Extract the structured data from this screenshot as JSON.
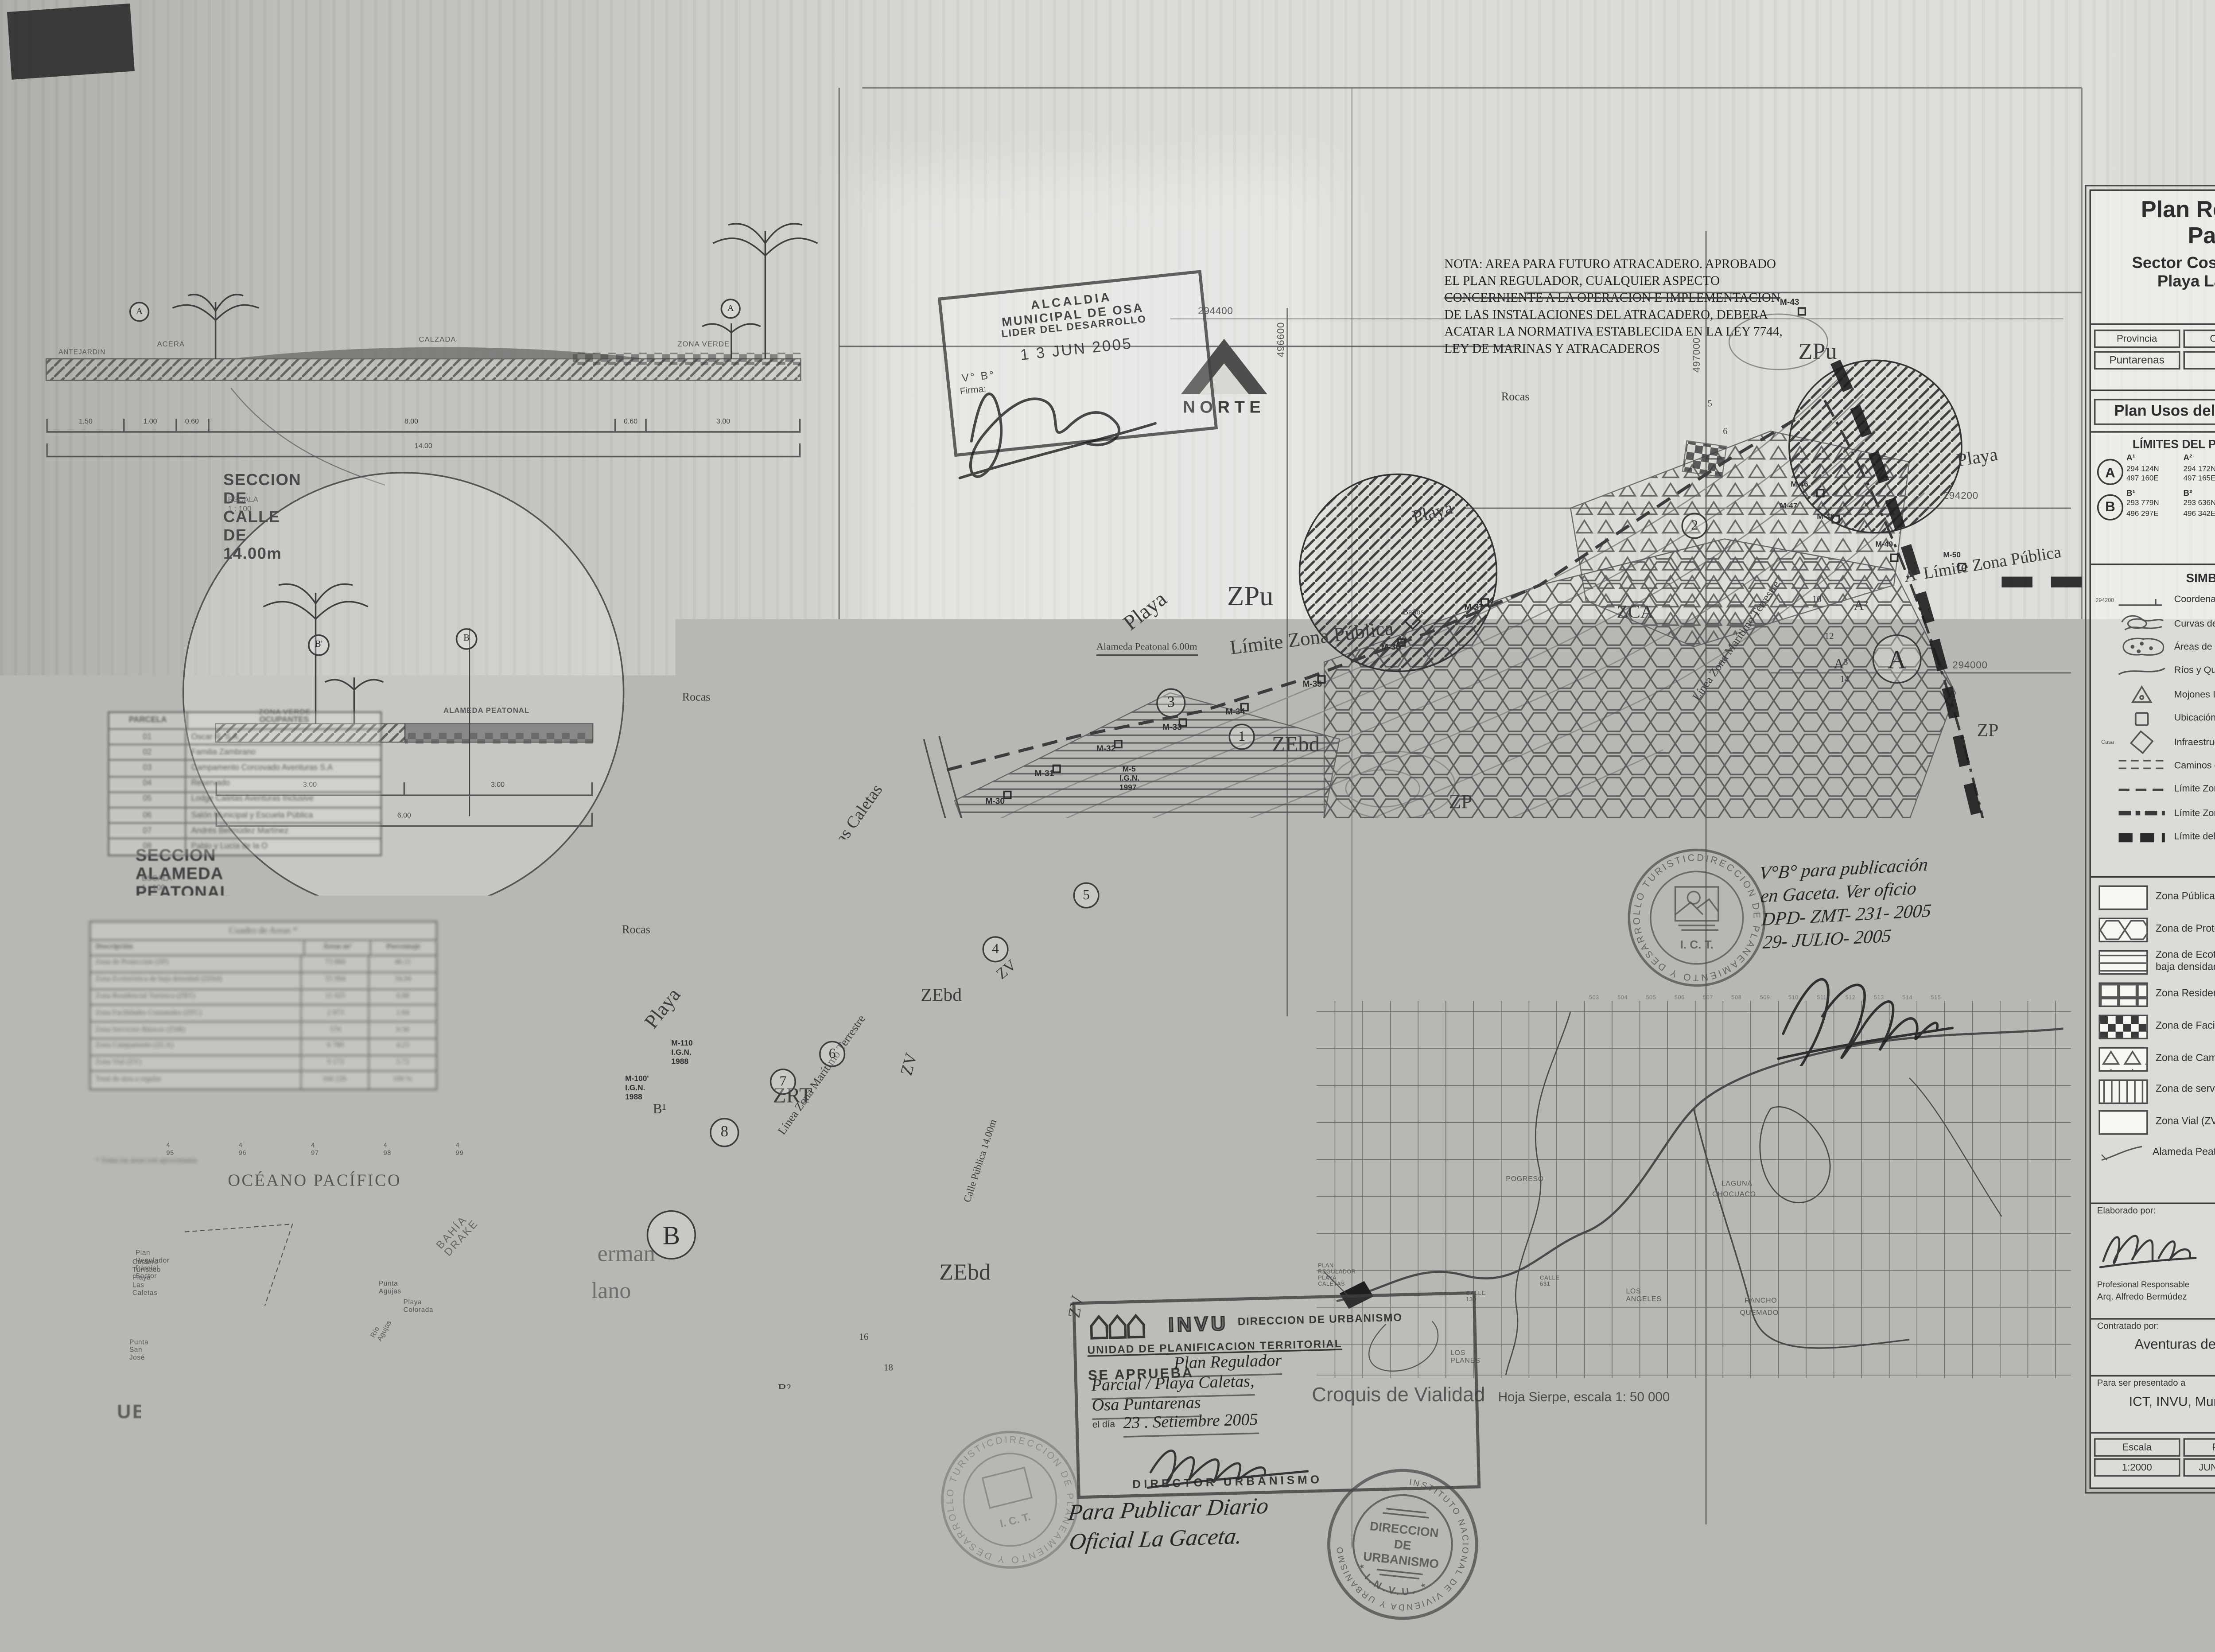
{
  "title_block": {
    "title1": "Plan Regulador",
    "title2": "Parcial",
    "subtitle1": "Sector Costero Turístico",
    "subtitle2": "Playa Las Caletas",
    "admin_headers": [
      "Provincia",
      "Cantón",
      "Distrito"
    ],
    "admin_values": [
      "Puntarenas",
      "Osa",
      "Sierpe"
    ],
    "plan_title": "Plan Usos del Suelo y Vialidad",
    "limits": {
      "heading": "LÍMITES DEL PLAN REGULADOR",
      "a_label": "A",
      "b_label": "B",
      "a_points": [
        {
          "p": "A¹",
          "n": "294 124N",
          "e": "497 160E"
        },
        {
          "p": "A²",
          "n": "294 172N",
          "e": "497 165E"
        },
        {
          "p": "A³",
          "n": "294 119N",
          "e": "497 152E"
        },
        {
          "p": "A⁴",
          "n": "294 019N",
          "e": "497 189E"
        }
      ],
      "b_points": [
        {
          "p": "B¹",
          "n": "293 779N",
          "e": "496 297E"
        },
        {
          "p": "B²",
          "n": "293 636N",
          "e": "496 342E"
        }
      ]
    },
    "simbologia_heading": "SIMBOLOGÍA",
    "simbologia": [
      {
        "icon": "#sym-lambert",
        "note": "294200",
        "label": "Coordenadas Lambert"
      },
      {
        "icon": "#sym-contour",
        "note": "",
        "label": "Curvas de NiveL @ 2.00m"
      },
      {
        "icon": "#sym-marsh",
        "note": "",
        "label": "Áreas de encharcamiento"
      },
      {
        "icon": "#sym-river",
        "note": "",
        "label": "Ríos y Quebradas"
      },
      {
        "icon": "#sym-mojon",
        "note": "",
        "label": "Mojones I.G.N."
      },
      {
        "icon": "#sym-mojonhip",
        "note": "",
        "label": "Ubicación hipotética de mojones"
      },
      {
        "icon": "#sym-infra",
        "note": "Casa",
        "label": "Infraestructura existente"
      },
      {
        "icon": "#sym-camino",
        "note": "",
        "label": "Caminos existentes"
      },
      {
        "icon": "#sym-lzp",
        "note": "",
        "label": "Límite Zona Pública"
      },
      {
        "icon": "#sym-lzmt",
        "note": "",
        "label": "Límite Zona Marítimo Terrestre"
      },
      {
        "icon": "#sym-lpr",
        "note": "",
        "label": "Límite del Plan Regulador"
      }
    ],
    "zones": [
      {
        "fill": "url(#pat-plain)",
        "label": "Zona Pública (ZPu)",
        "label2": ""
      },
      {
        "fill": "url(#pat-hex)",
        "label": "Zona de Protección (ZP)",
        "label2": ""
      },
      {
        "fill": "url(#pat-hlines)",
        "label": "Zona de Ecoturistica de",
        "label2": "baja densidad (ZEbd)"
      },
      {
        "fill": "url(#pat-grid)",
        "label": "Zona Residencial Turística (ZRT)",
        "label2": ""
      },
      {
        "fill": "url(#pat-checker)",
        "label": "Zona de Facilidades Comunales (ZFC)",
        "label2": ""
      },
      {
        "fill": "url(#pat-tri)",
        "label": "Zona de Campamento (ZCA)",
        "label2": ""
      },
      {
        "fill": "url(#pat-vlines)",
        "label": "Zona de servicios básicos (ZSB)",
        "label2": ""
      },
      {
        "fill": "url(#pat-plain)",
        "label": "Zona Vial  (ZV)",
        "label2": ""
      }
    ],
    "alameda_label": "Alameda Peatonal",
    "elaborado_label": "Elaborado por:",
    "profesional_role": "Profesional Responsable",
    "profesional_name": "Arq. Alfredo Bermúdez",
    "deppat": "DEPPAT",
    "reg": "N° de Reg A-4043",
    "contratado_label": "Contratado por:",
    "contratado_value": "Aventuras de Corcovado S.A.",
    "presentado_label": "Para ser presentado a",
    "presentado_value": "ICT, INVU, Municipalidad de Osa",
    "footer_headers": [
      "Escala",
      "Fecha",
      "Lamina"
    ],
    "footer_values": [
      "1:2000",
      "JUNIO 2005",
      "19"
    ]
  },
  "nota_lines": [
    "NOTA: AREA PARA FUTURO ATRACADERO. APROBADO",
    "EL PLAN REGULADOR, CUALQUIER ASPECTO",
    "CONCERNIENTE A LA OPERACION E IMPLEMENTACION",
    "DE LAS INSTALACIONES DEL ATRACADERO, DEBERA",
    "ACATAR LA NORMATIVA ESTABLECIDA EN LA LEY 7744,",
    "LEY DE MARINAS Y ATRACADEROS"
  ],
  "norte": "NORTE",
  "street_section": {
    "title": "SECCION DE CALLE DE 14.00m",
    "scale": "ESCALA  1 : 100",
    "labels": [
      "ANTEJARDIN",
      "ACERA",
      "CALZADA",
      "ZONA VERDE"
    ],
    "marker": "A",
    "dims": [
      "1.50",
      "1.00",
      "0.60",
      "8.00",
      "0.60",
      "3.00"
    ],
    "total": "14.00"
  },
  "alameda_section": {
    "title": "SECCION ALAMEDA PEATONAL DE 6.00m",
    "scale": "ESCALA  1 : 100",
    "label_left": "ZONA VERDE",
    "label_right": "ALAMEDA PEATONAL",
    "marker_left": "B'",
    "marker_right": "B",
    "dims": [
      "3.00",
      "3.00"
    ],
    "total": "6.00"
  },
  "parcelas": {
    "headers": [
      "PARCELA",
      "OCUPANTES"
    ],
    "rows": [
      [
        "01",
        "Oscar R. S.A."
      ],
      [
        "02",
        "Familia Zambrano"
      ],
      [
        "03",
        "Campamento Corcovado Aventuras S.A"
      ],
      [
        "04",
        "Reservado"
      ],
      [
        "05",
        "Lodge Caletas Aventuras Inclusive"
      ],
      [
        "06",
        "Salón Municipal y Escuela Pública"
      ],
      [
        "07",
        "Andrés Bermúdez Martínez"
      ],
      [
        "08",
        "Pablo y Lucía de la O"
      ]
    ]
  },
  "areas": {
    "title": "Cuadro de Areas *",
    "headers": [
      "Descripción",
      "Áreas m²",
      "Porcentaje"
    ],
    "rows": [
      [
        "Zona de Protección (ZP)",
        "73 860",
        "46.11"
      ],
      [
        "Zona Ecoturística de baja densidad (ZEbd)",
        "55 994",
        "34.94"
      ],
      [
        "Zona Residencial Turística (ZRT)",
        "11 025",
        "6.88"
      ],
      [
        "Zona Facilidades Comunales (ZFC)",
        "2 973",
        "1.84"
      ],
      [
        "Zona Servicios Básicos (ZSB)",
        "570",
        "0.36"
      ],
      [
        "Zona Campamento (ZCA)",
        "6 780",
        "4.23"
      ],
      [
        "Zona Vial (ZV)",
        "9 173",
        "5.72"
      ]
    ],
    "total_row": [
      "Total de área a regular",
      "160 226",
      "100 %"
    ],
    "footnote": "*   Todas las áreas son aproximadas"
  },
  "ubicacion": {
    "ocean": "OCÉANO PACÍFICO",
    "ticks": [
      "4 95",
      "4 96",
      "4 97",
      "4 98",
      "4 99"
    ],
    "labels": [
      {
        "text": "Plan Regulador Parcial Sector",
        "style": "left:88px;top:811px;font-size:4.4px;"
      },
      {
        "text": "Costero Turístico Playa Las Caletas",
        "style": "left:86px;top:817px;font-size:4.4px;"
      },
      {
        "text": "BAHÍA DRAKE",
        "style": "left:283px;top:795px;font-size:7px;transform:rotate(-48deg);letter-spacing:1px;color:#666;"
      },
      {
        "text": "Punta Agujas",
        "style": "left:246px;top:831px;font-size:4.4px;"
      },
      {
        "text": "Playa Colorada",
        "style": "left:262px;top:843px;font-size:4.4px;"
      },
      {
        "text": "Punta San José",
        "style": "left:84px;top:869px;font-size:4.4px;"
      },
      {
        "text": "Río Agujas",
        "style": "left:240px;top:858px;font-size:4.4px;transform:rotate(-62deg);"
      }
    ],
    "caption": "UBICACIÓN GEOGRÁFICA",
    "caption2": "Hoja Topográfica Sierpe. Escala 1:50000 I.G.N."
  },
  "croquis": {
    "title": "Croquis de Vialidad",
    "subtitle": "Hoja Sierpe, escala 1: 50 000",
    "cols": [
      "503",
      "504",
      "505",
      "506",
      "507",
      "508",
      "509",
      "510",
      "511",
      "512",
      "513",
      "514",
      "515"
    ],
    "labels": [
      {
        "text": "POGRESO",
        "style": "left:978px;top:763px;"
      },
      {
        "text": "LAGUNA",
        "style": "left:1118px;top:766px;"
      },
      {
        "text": "CHOCUACO",
        "style": "left:1112px;top:773px;"
      },
      {
        "text": "LOS ANGELES",
        "style": "left:1056px;top:836px;"
      },
      {
        "text": "CALLE 631",
        "style": "left:1000px;top:828px;font-size:3.8px;"
      },
      {
        "text": "CALLE 130",
        "style": "left:952px;top:838px;font-size:3.8px;"
      },
      {
        "text": "LOS PLANES",
        "style": "left:942px;top:876px;"
      },
      {
        "text": "RANCHO",
        "style": "left:1133px;top:842px;"
      },
      {
        "text": "QUEMADO",
        "style": "left:1130px;top:850px;"
      },
      {
        "text": "PLAN REGULADOR PLAYA CALETAS",
        "style": "left:856px;top:820px;font-size:3.6px;"
      }
    ]
  },
  "stamps": {
    "alcaldia": {
      "l1": "ALCALDIA",
      "l2": "MUNICIPAL DE OSA",
      "l3": "LIDER DEL DESARROLLO",
      "date": "1 3  JUN 2005",
      "vb": "V° B°",
      "firma": "Firma:"
    },
    "ict": {
      "ring": "DIRECCION DE PLANEAMIENTO Y DESARROLLO TURISTICO *",
      "center": "I. C. T."
    },
    "invu_box": {
      "brand": "INVU",
      "t1": "DIRECCION DE URBANISMO",
      "t2": "UNIDAD DE PLANIFICACION TERRITORIAL",
      "t3": "SE APRUEBA",
      "hand1": "Plan Regulador",
      "hand2": "Parcial / Playa Caletas,",
      "hand3": "Osa  Puntarenas",
      "dia": "el día",
      "hand4": "23 .   Setiembre 2005",
      "sig_role": "DIRECTOR URBANISMO"
    },
    "invu_round": {
      "ring": "INSTITUTO NACIONAL DE VIVIENDA Y URBANISMO",
      "star": "* I.N.V.U. *",
      "c1": "DIRECCION",
      "c2": "DE",
      "c3": "URBANISMO"
    }
  },
  "handwriting": {
    "vobo": [
      "V°B° para publicación",
      "en Gaceta. Ver oficio",
      "DPD- ZMT- 231- 2005",
      "29- JULIO- 2005"
    ],
    "gaceta": [
      "Para Publicar Diario",
      "Oficial La Gaceta."
    ]
  },
  "map": {
    "coords": [
      {
        "text": "294400",
        "style": "left:778px;top:200px;font-size:6.5px;"
      },
      {
        "text": "496600",
        "style": "left:830px;top:232px;font-size:6.5px;transform:rotate(-90deg);"
      },
      {
        "text": "497000",
        "style": "left:1100px;top:242px;font-size:6.5px;transform:rotate(-90deg);"
      },
      {
        "text": "294200",
        "style": "left:1262px;top:320px;font-size:6.5px;"
      },
      {
        "text": "294000",
        "style": "left:1268px;top:430px;font-size:6.5px;"
      }
    ],
    "labels": [
      {
        "text": "ZPu",
        "style": "left:797px;top:378px;font-size:18px;"
      },
      {
        "text": "ZPu",
        "style": "left:1168px;top:222px;font-size:15px;"
      },
      {
        "text": "ZPu",
        "style": "left:570px;top:588px;font-size:14px;"
      },
      {
        "text": "ZP",
        "style": "left:941px;top:514px;font-size:13px;"
      },
      {
        "text": "ZP",
        "style": "left:1284px;top:468px;font-size:12px;"
      },
      {
        "text": "ZEbd",
        "style": "left:826px;top:478px;font-size:14px;"
      },
      {
        "text": "ZEbd",
        "style": "left:698px;top:543px;font-size:12px;"
      },
      {
        "text": "ZEbd",
        "style": "left:598px;top:640px;font-size:12px;"
      },
      {
        "text": "ZEbd",
        "style": "left:610px;top:820px;font-size:15px;"
      },
      {
        "text": "ZCA",
        "style": "left:1050px;top:391px;font-size:12px;"
      },
      {
        "text": "ZRT",
        "style": "left:502px;top:706px;font-size:14px;"
      },
      {
        "text": "ZV",
        "style": "left:584px;top:697px;font-size:11px;transform:rotate(-75deg);"
      },
      {
        "text": "ZV",
        "style": "left:646px;top:631px;font-size:10px;transform:rotate(-40deg);"
      },
      {
        "text": "ZV",
        "style": "left:693px;top:855px;font-size:11px;transform:rotate(-80deg);"
      },
      {
        "text": "Calle Pública 14.00m",
        "style": "left:626px;top:780px;font-size:6.5px;transform:rotate(-72deg);"
      },
      {
        "text": "Límite Zona Pública",
        "style": "left:798px;top:414px;font-size:13px;transform:rotate(-7deg);"
      },
      {
        "text": "A' Límite Zona Pública",
        "style": "left:1236px;top:370px;font-size:11px;transform:rotate(-9deg);"
      },
      {
        "text": "Alameda Peatonal 6.00m",
        "style": "left:712px;top:418px;font-size:6.5px;border-bottom:.8px solid #444;"
      },
      {
        "text": "Playa",
        "style": "left:728px;top:402px;font-size:14px;transform:rotate(-38deg);"
      },
      {
        "text": "Playa",
        "style": "left:916px;top:330px;font-size:12px;transform:rotate(-14deg);"
      },
      {
        "text": "Playa",
        "style": "left:1270px;top:293px;font-size:12px;transform:rotate(-9deg);"
      },
      {
        "text": "Playa",
        "style": "left:416px;top:662px;font-size:13px;transform:rotate(-52deg);"
      },
      {
        "text": "Playa Las Caletas",
        "style": "left:522px;top:572px;font-size:11px;transform:rotate(-55deg);"
      },
      {
        "text": "Quebrada Caletas",
        "style": "left:898px;top:572px;font-size:9px;transform:rotate(-33deg);"
      },
      {
        "text": "Línea Zona Marítimo Terrestre",
        "style": "left:1098px;top:452px;font-size:7.5px;transform:rotate(-55deg);"
      },
      {
        "text": "Línea Zona Marítimo Terrestre",
        "style": "left:504px;top:734px;font-size:7.5px;transform:rotate(-55deg);"
      },
      {
        "text": "Línea Zona Marítima Terrestre",
        "style": "left:494px;top:945px;font-size:8.5px;transform:rotate(-14deg);"
      },
      {
        "text": "Rocas",
        "style": "left:975px;top:254px;font-size:7.5px;"
      },
      {
        "text": "Rocas",
        "style": "left:443px;top:449px;font-size:7.5px;"
      },
      {
        "text": "Rocas",
        "style": "left:404px;top:600px;font-size:7.5px;"
      },
      {
        "text": "Baños",
        "style": "left:911px;top:396px;font-size:5.5px;"
      },
      {
        "text": "erman",
        "style": "left:388px;top:808px;font-size:15px;color:#6e6e6e;"
      },
      {
        "text": "lano",
        "style": "left:384px;top:832px;font-size:15px;color:#6e6e6e;"
      },
      {
        "text": "M-30",
        "cls": "mj",
        "style": "left:640px;top:519px;font-size:5.5px;"
      },
      {
        "text": "M-31",
        "cls": "mj",
        "style": "left:672px;top:501px;font-size:5.5px;"
      },
      {
        "text": "M-32",
        "cls": "mj",
        "style": "left:712px;top:485px;font-size:5.5px;"
      },
      {
        "text": "M-33",
        "cls": "mj",
        "style": "left:755px;top:471px;font-size:5.5px;"
      },
      {
        "text": "M-34",
        "cls": "mj",
        "style": "left:796px;top:461px;font-size:5.5px;"
      },
      {
        "text": "M-35",
        "cls": "mj",
        "style": "left:846px;top:443px;font-size:5.5px;"
      },
      {
        "text": "M-36",
        "cls": "mj",
        "style": "left:897px;top:419px;font-size:5.5px;"
      },
      {
        "text": "M-37",
        "cls": "mj",
        "style": "left:951px;top:393px;font-size:5.5px;"
      },
      {
        "text": "M-43",
        "cls": "mj",
        "style": "left:1156px;top:195px;font-size:5.5px;"
      },
      {
        "text": "M-46",
        "cls": "mj",
        "style": "left:1163px;top:313px;font-size:5px;"
      },
      {
        "text": "M-47",
        "cls": "mj",
        "style": "left:1156px;top:327px;font-size:5px;"
      },
      {
        "text": "M-48",
        "cls": "mj",
        "style": "left:1180px;top:334px;font-size:5px;"
      },
      {
        "text": "M-49",
        "cls": "mj",
        "style": "left:1218px;top:352px;font-size:5px;"
      },
      {
        "text": "M-50",
        "cls": "mj",
        "style": "left:1262px;top:359px;font-size:5px;"
      },
      {
        "text": "M-5",
        "cls": "mj",
        "style": "left:729px;top:498px;font-size:5px;"
      },
      {
        "text": "I.G.N.",
        "cls": "mj",
        "style": "left:727px;top:504px;font-size:5px;"
      },
      {
        "text": "1997",
        "cls": "mj",
        "style": "left:727px;top:510px;font-size:5px;"
      },
      {
        "text": "M-110",
        "cls": "mj",
        "style": "left:436px;top:676px;font-size:5px;"
      },
      {
        "text": "I.G.N.",
        "cls": "mj",
        "style": "left:436px;top:682px;font-size:5px;"
      },
      {
        "text": "1988",
        "cls": "mj",
        "style": "left:436px;top:688px;font-size:5px;"
      },
      {
        "text": "M-100'",
        "cls": "mj",
        "style": "left:406px;top:699px;font-size:5px;"
      },
      {
        "text": "I.G.N.",
        "cls": "mj",
        "style": "left:406px;top:705px;font-size:5px;"
      },
      {
        "text": "1988",
        "cls": "mj",
        "style": "left:406px;top:711px;font-size:5px;"
      },
      {
        "text": "B¹",
        "style": "left:424px;top:716px;font-size:9px;"
      },
      {
        "text": "B²",
        "style": "left:505px;top:898px;font-size:9px;"
      },
      {
        "text": "A²",
        "style": "left:1204px;top:389px;font-size:9px;"
      },
      {
        "text": "A³",
        "style": "left:1191px;top:427px;font-size:9px;"
      },
      {
        "text": "5",
        "style": "left:1109px;top:260px;font-size:6px;"
      },
      {
        "text": "6",
        "style": "left:1119px;top:278px;font-size:6px;"
      },
      {
        "text": "10",
        "style": "left:1177px;top:387px;font-size:6px;"
      },
      {
        "text": "12",
        "style": "left:1185px;top:411px;font-size:6px;"
      },
      {
        "text": "14",
        "style": "left:1195px;top:439px;font-size:6px;"
      },
      {
        "text": "16",
        "style": "left:558px;top:866px;font-size:6px;"
      },
      {
        "text": "18",
        "style": "left:574px;top:886px;font-size:6px;"
      }
    ],
    "circles": [
      {
        "text": "A",
        "style": "left:1216px;top:412px;width:30px;height:30px;font-size:17px;"
      },
      {
        "text": "B",
        "style": "left:420px;top:786px;width:30px;height:30px;font-size:17px;"
      },
      {
        "text": "1",
        "style": "left:798px;top:470px;width:15px;height:15px;font-size:9px;"
      },
      {
        "text": "2",
        "style": "left:1092px;top:333px;width:15px;height:15px;font-size:9px;"
      },
      {
        "text": "3",
        "style": "left:751px;top:447px;width:17px;height:17px;font-size:10px;"
      },
      {
        "text": "4",
        "style": "left:638px;top:608px;width:15px;height:15px;font-size:9px;"
      },
      {
        "text": "5",
        "style": "left:697px;top:573px;width:15px;height:15px;font-size:9px;"
      },
      {
        "text": "6",
        "style": "left:532px;top:676px;width:15px;height:15px;font-size:9px;"
      },
      {
        "text": "7",
        "style": "left:500px;top:694px;width:15px;height:15px;font-size:9px;"
      },
      {
        "text": "8",
        "style": "left:461px;top:726px;width:17px;height:17px;font-size:10px;"
      }
    ]
  }
}
